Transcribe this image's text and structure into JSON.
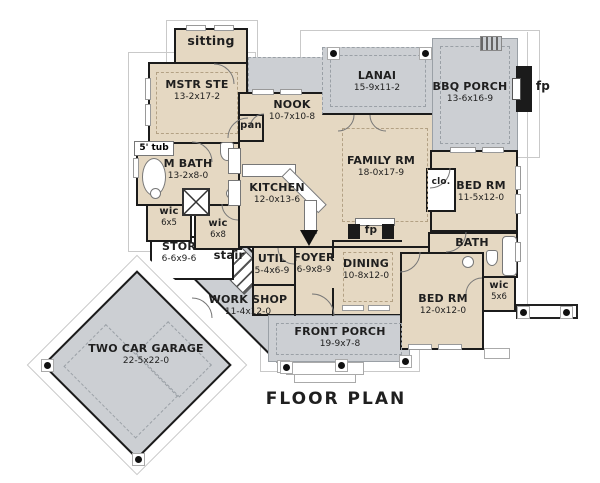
{
  "title": "FLOOR PLAN",
  "labels": {
    "fp": "fp"
  },
  "colors": {
    "room_fill": "#e5d8c2",
    "porch_fill": "#cccfd3",
    "wall": "#1b1b1b"
  },
  "rooms": {
    "sitting": {
      "name": "sitting"
    },
    "mstr_ste": {
      "name": "MSTR STE",
      "dims": "13-2x17-2"
    },
    "tub": {
      "name": "5' tub"
    },
    "m_bath": {
      "name": "M BATH",
      "dims": "13-2x8-0"
    },
    "wic_6x5": {
      "name": "wic",
      "dims": "6x5"
    },
    "wic_6x8": {
      "name": "wic",
      "dims": "6x8"
    },
    "pan": {
      "name": "pan"
    },
    "nook": {
      "name": "NOOK",
      "dims": "10-7x10-8"
    },
    "kitchen": {
      "name": "KITCHEN",
      "dims": "12-0x13-6"
    },
    "family_rm": {
      "name": "FAMILY RM",
      "dims": "18-0x17-9"
    },
    "lanai": {
      "name": "LANAI",
      "dims": "15-9x11-2"
    },
    "bbq_porch": {
      "name": "BBQ PORCH",
      "dims": "13-6x16-9"
    },
    "clo": {
      "name": "clo."
    },
    "bed_rm_1": {
      "name": "BED RM",
      "dims": "11-5x12-0"
    },
    "bath": {
      "name": "BATH"
    },
    "wic_5x6": {
      "name": "wic",
      "dims": "5x6"
    },
    "bed_rm_2": {
      "name": "BED RM",
      "dims": "12-0x12-0"
    },
    "dining": {
      "name": "DINING",
      "dims": "10-8x12-0"
    },
    "foyer": {
      "name": "FOYER",
      "dims": "6-9x8-9"
    },
    "util": {
      "name": "UTIL",
      "dims": "5-4x6-9"
    },
    "stor": {
      "name": "STOR",
      "dims": "6-6x9-6"
    },
    "stair": {
      "name": "stair"
    },
    "work_shop": {
      "name": "WORK SHOP",
      "dims": "11-4x12-0"
    },
    "garage": {
      "name": "TWO CAR GARAGE",
      "dims": "22-5x22-0"
    },
    "front_porch": {
      "name": "FRONT PORCH",
      "dims": "19-9x7-8"
    }
  }
}
